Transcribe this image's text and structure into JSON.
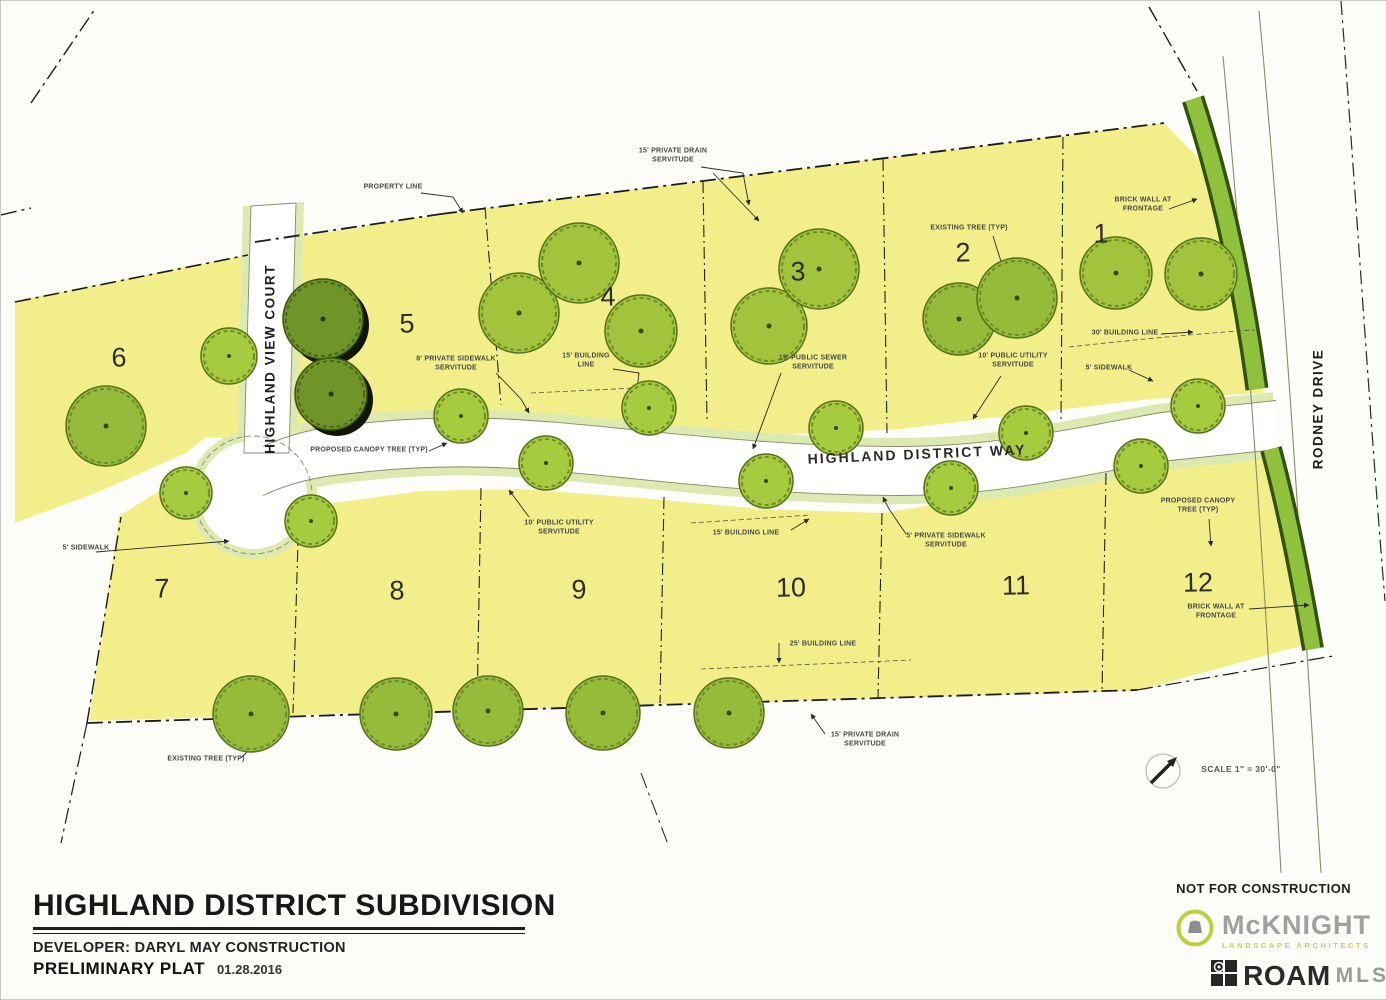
{
  "document": {
    "title": "HIGHLAND DISTRICT SUBDIVISION",
    "developer_label": "DEVELOPER: DARYL MAY CONSTRUCTION",
    "plat_type": "PRELIMINARY PLAT",
    "date": "01.28.2016",
    "disclaimer": "NOT FOR CONSTRUCTION",
    "scale_note": "SCALE 1\" = 30'-0\""
  },
  "logos": {
    "mcknight_name": "McKNIGHT",
    "mcknight_tagline": "LANDSCAPE ARCHITECTS",
    "roam_name": "ROAM",
    "roam_suffix": "MLS"
  },
  "plat": {
    "streets": {
      "highland_view_court": "HIGHLAND VIEW COURT",
      "highland_district_way": "HIGHLAND DISTRICT WAY",
      "rodney_drive": "RODNEY DRIVE"
    },
    "lots": [
      "1",
      "2",
      "3",
      "4",
      "5",
      "6",
      "7",
      "8",
      "9",
      "10",
      "11",
      "12"
    ],
    "annotations": [
      {
        "id": "property-line",
        "text": "PROPERTY LINE"
      },
      {
        "id": "drain-servitude-top",
        "text": "15' PRIVATE DRAIN\nSERVITUDE"
      },
      {
        "id": "sidewalk-servitude-8",
        "text": "8' PRIVATE SIDEWALK\nSERVITUDE"
      },
      {
        "id": "building-line-top",
        "text": "15' BUILDING\nLINE"
      },
      {
        "id": "canopy-tree-left",
        "text": "PROPOSED CANOPY TREE (TYP)"
      },
      {
        "id": "utility-servitude-mid",
        "text": "10' PUBLIC UTILITY\nSERVITUDE"
      },
      {
        "id": "building-line-mid",
        "text": "15' BUILDING LINE"
      },
      {
        "id": "sewer-servitude",
        "text": "15' PUBLIC SEWER\nSERVITUDE"
      },
      {
        "id": "utility-servitude-right",
        "text": "10' PUBLIC UTILITY\nSERVITUDE"
      },
      {
        "id": "existing-tree-top",
        "text": "EXISTING TREE (TYP)"
      },
      {
        "id": "brick-wall-top",
        "text": "BRICK WALL AT\nFRONTAGE"
      },
      {
        "id": "building-line-30",
        "text": "30' BUILDING LINE"
      },
      {
        "id": "sidewalk-right",
        "text": "5' SIDEWALK"
      },
      {
        "id": "sidewalk-servitude-5",
        "text": "5' PRIVATE SIDEWALK\nSERVITUDE"
      },
      {
        "id": "canopy-tree-right",
        "text": "PROPOSED CANOPY\nTREE (TYP)"
      },
      {
        "id": "brick-wall-bottom",
        "text": "BRICK WALL AT\nFRONTAGE"
      },
      {
        "id": "building-line-25",
        "text": "25' BUILDING LINE"
      },
      {
        "id": "drain-servitude-bottom",
        "text": "15' PRIVATE DRAIN\nSERVITUDE"
      },
      {
        "id": "existing-tree-bottom",
        "text": "EXISTING TREE (TYP)"
      },
      {
        "id": "sidewalk-left",
        "text": "5' SIDEWALK"
      }
    ],
    "colors": {
      "lot_fill": "#f2ef8b",
      "street_edge": "#dce9b0",
      "tree_green": "#a2c43c",
      "dark_tree_green": "#6f9428",
      "landscape_strip": "#8fc13c",
      "line_black": "#1b1b1b"
    }
  }
}
